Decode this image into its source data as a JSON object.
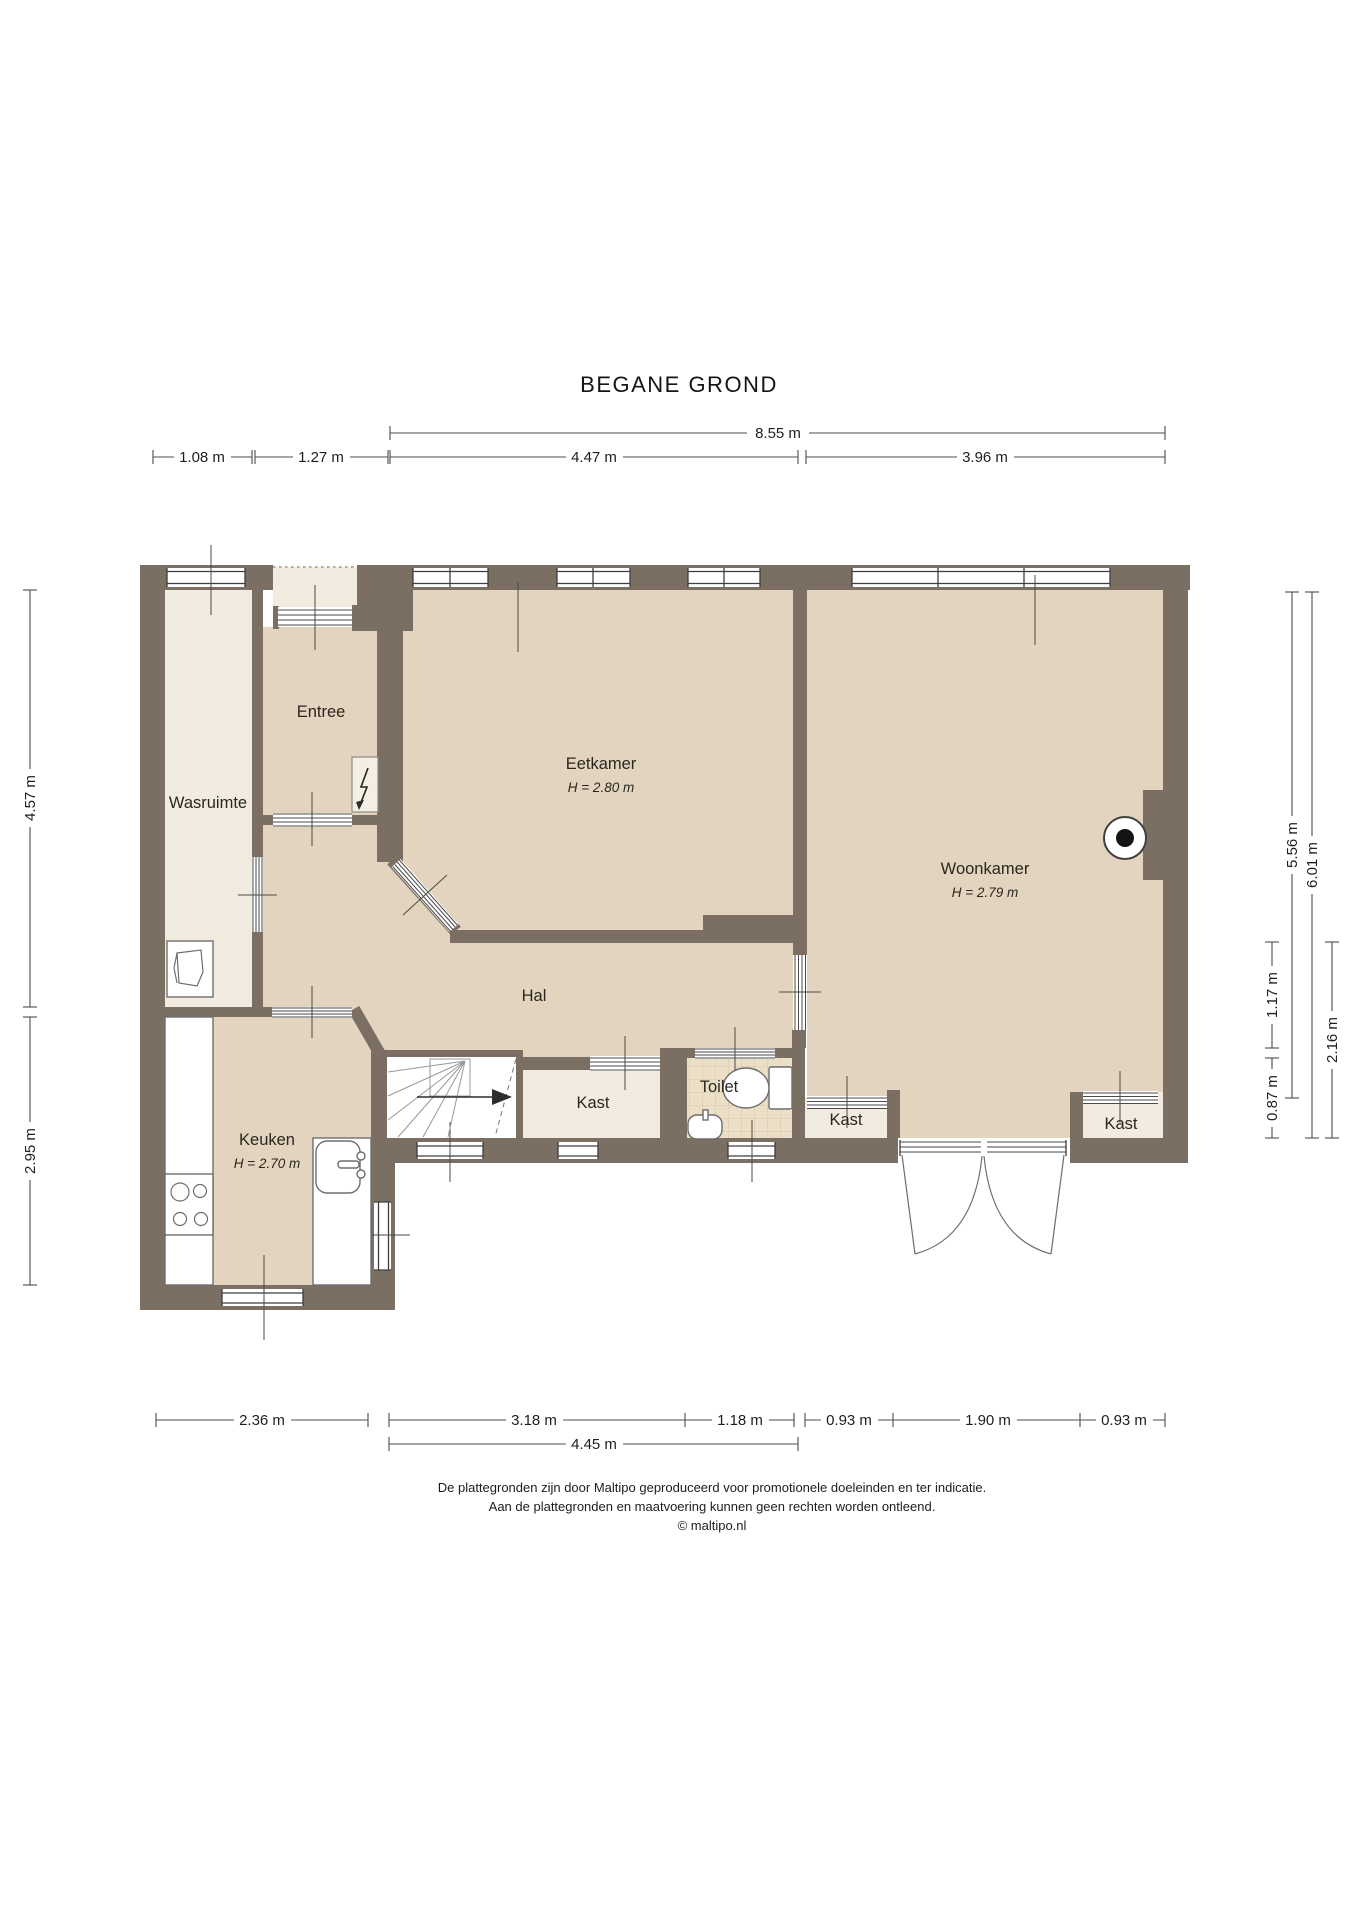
{
  "title": "BEGANE GROND",
  "rooms": {
    "wasruimte": {
      "label": "Wasruimte"
    },
    "entree": {
      "label": "Entree"
    },
    "eetkamer": {
      "label": "Eetkamer",
      "ceiling": "H = 2.80 m"
    },
    "woonkamer": {
      "label": "Woonkamer",
      "ceiling": "H = 2.79 m"
    },
    "hal": {
      "label": "Hal"
    },
    "keuken": {
      "label": "Keuken",
      "ceiling": "H = 2.70 m"
    },
    "kast_hal": {
      "label": "Kast"
    },
    "toilet": {
      "label": "Toilet"
    },
    "kast_woonkamer_links": {
      "label": "Kast"
    },
    "kast_woonkamer_rechts": {
      "label": "Kast"
    }
  },
  "dimensions": {
    "top_total": "8.55 m",
    "top": [
      "1.08 m",
      "1.27 m",
      "4.47 m",
      "3.96 m"
    ],
    "left": [
      "4.57 m",
      "2.95 m"
    ],
    "right": [
      "5.56 m",
      "6.01 m",
      "1.17 m",
      "0.87 m",
      "2.16 m"
    ],
    "bottom": [
      "2.36 m",
      "3.18 m",
      "1.18 m",
      "0.93 m",
      "1.90 m",
      "0.93 m"
    ],
    "bottom_sub": "4.45 m"
  },
  "footer": {
    "line1": "De plattegronden zijn door Maltipo geproduceerd voor promotionele doeleinden en ter indicatie.",
    "line2": "Aan de plattegronden en maatvoering kunnen geen rechten worden ontleend.",
    "line3": "© maltipo.nl"
  },
  "colors": {
    "wall": "#7b6e63",
    "floor-main": "#e3d4bf",
    "floor-light": "#f2ece0",
    "floor-tile": "#ecdfc8",
    "tile-line": "#d8c5a9",
    "line": "#4c4c4c",
    "text": "#2b2620"
  }
}
